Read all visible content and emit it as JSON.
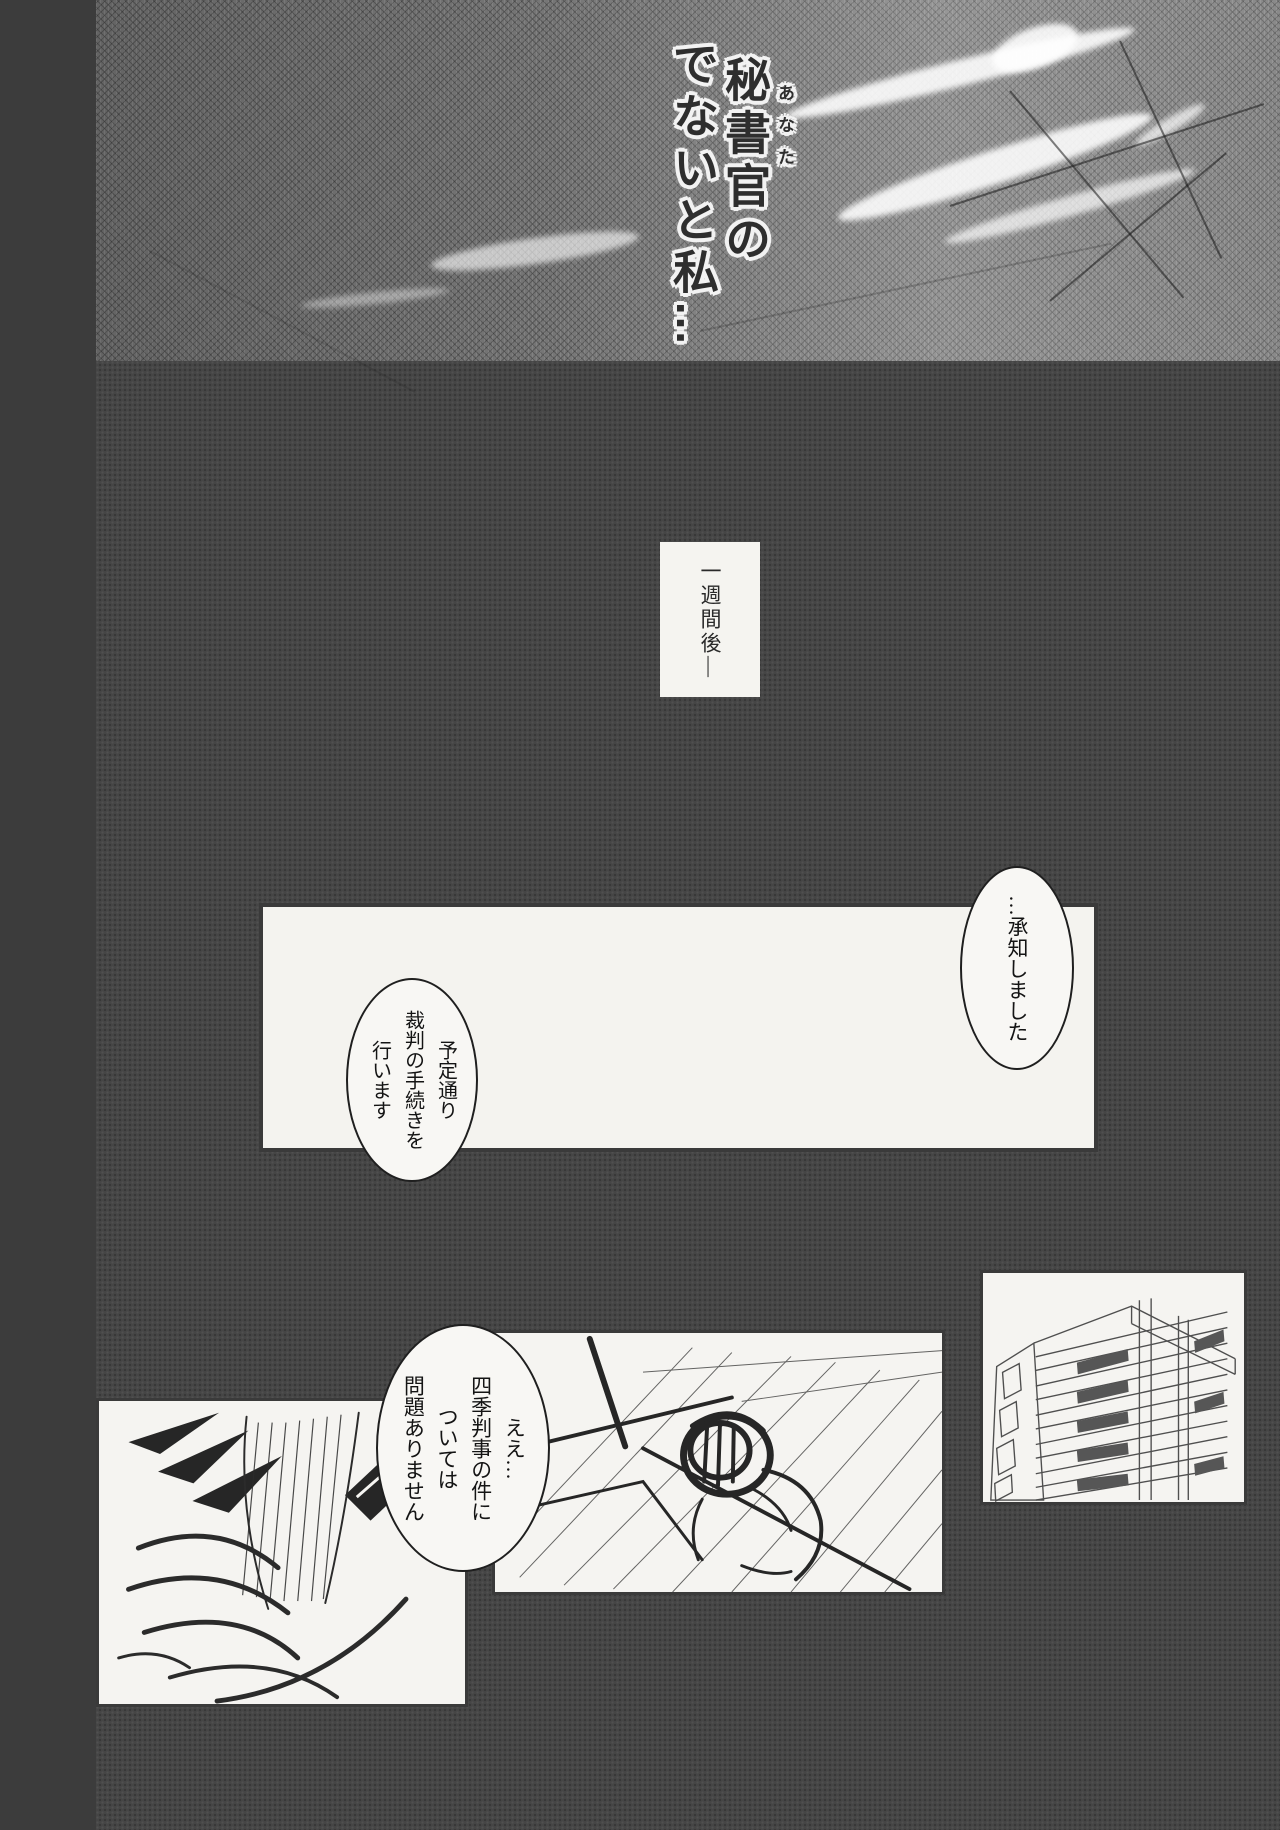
{
  "artwork": {
    "title": {
      "main": "秘書官の",
      "furigana": "あなた",
      "tail": "でないと私…"
    }
  },
  "caption": {
    "text": "一週間後―"
  },
  "bubbles": {
    "acknowledge": "…承知しました",
    "procedure": "予定通り\n裁判の手続きを\n行います",
    "report": "ええ…\n四季判事の件に\nついては\n問題ありません"
  },
  "colors": {
    "page_background": "#454545",
    "panel_background": "#f5f4f1",
    "ink": "#1f1f1f",
    "top_band_tone": "#7d7d7d"
  }
}
